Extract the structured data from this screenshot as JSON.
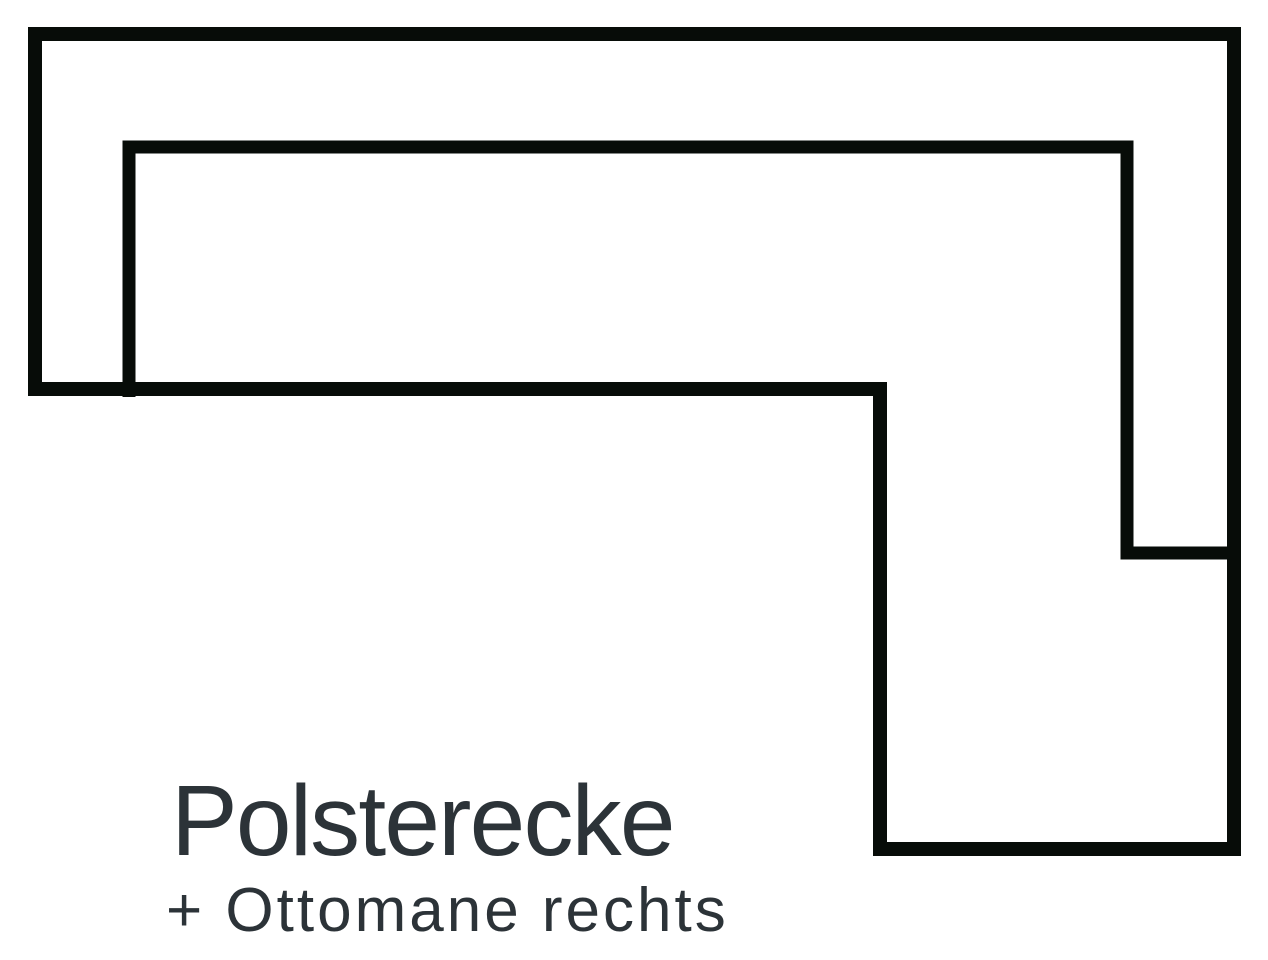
{
  "page": {
    "background_color": "#ffffff"
  },
  "diagram": {
    "kind": "sofa-floorplan-top-view",
    "line_color": "#070c08"
  },
  "caption": {
    "title": "Polsterecke",
    "subtitle": "+ Ottomane rechts",
    "text_color": "#2c3338"
  }
}
